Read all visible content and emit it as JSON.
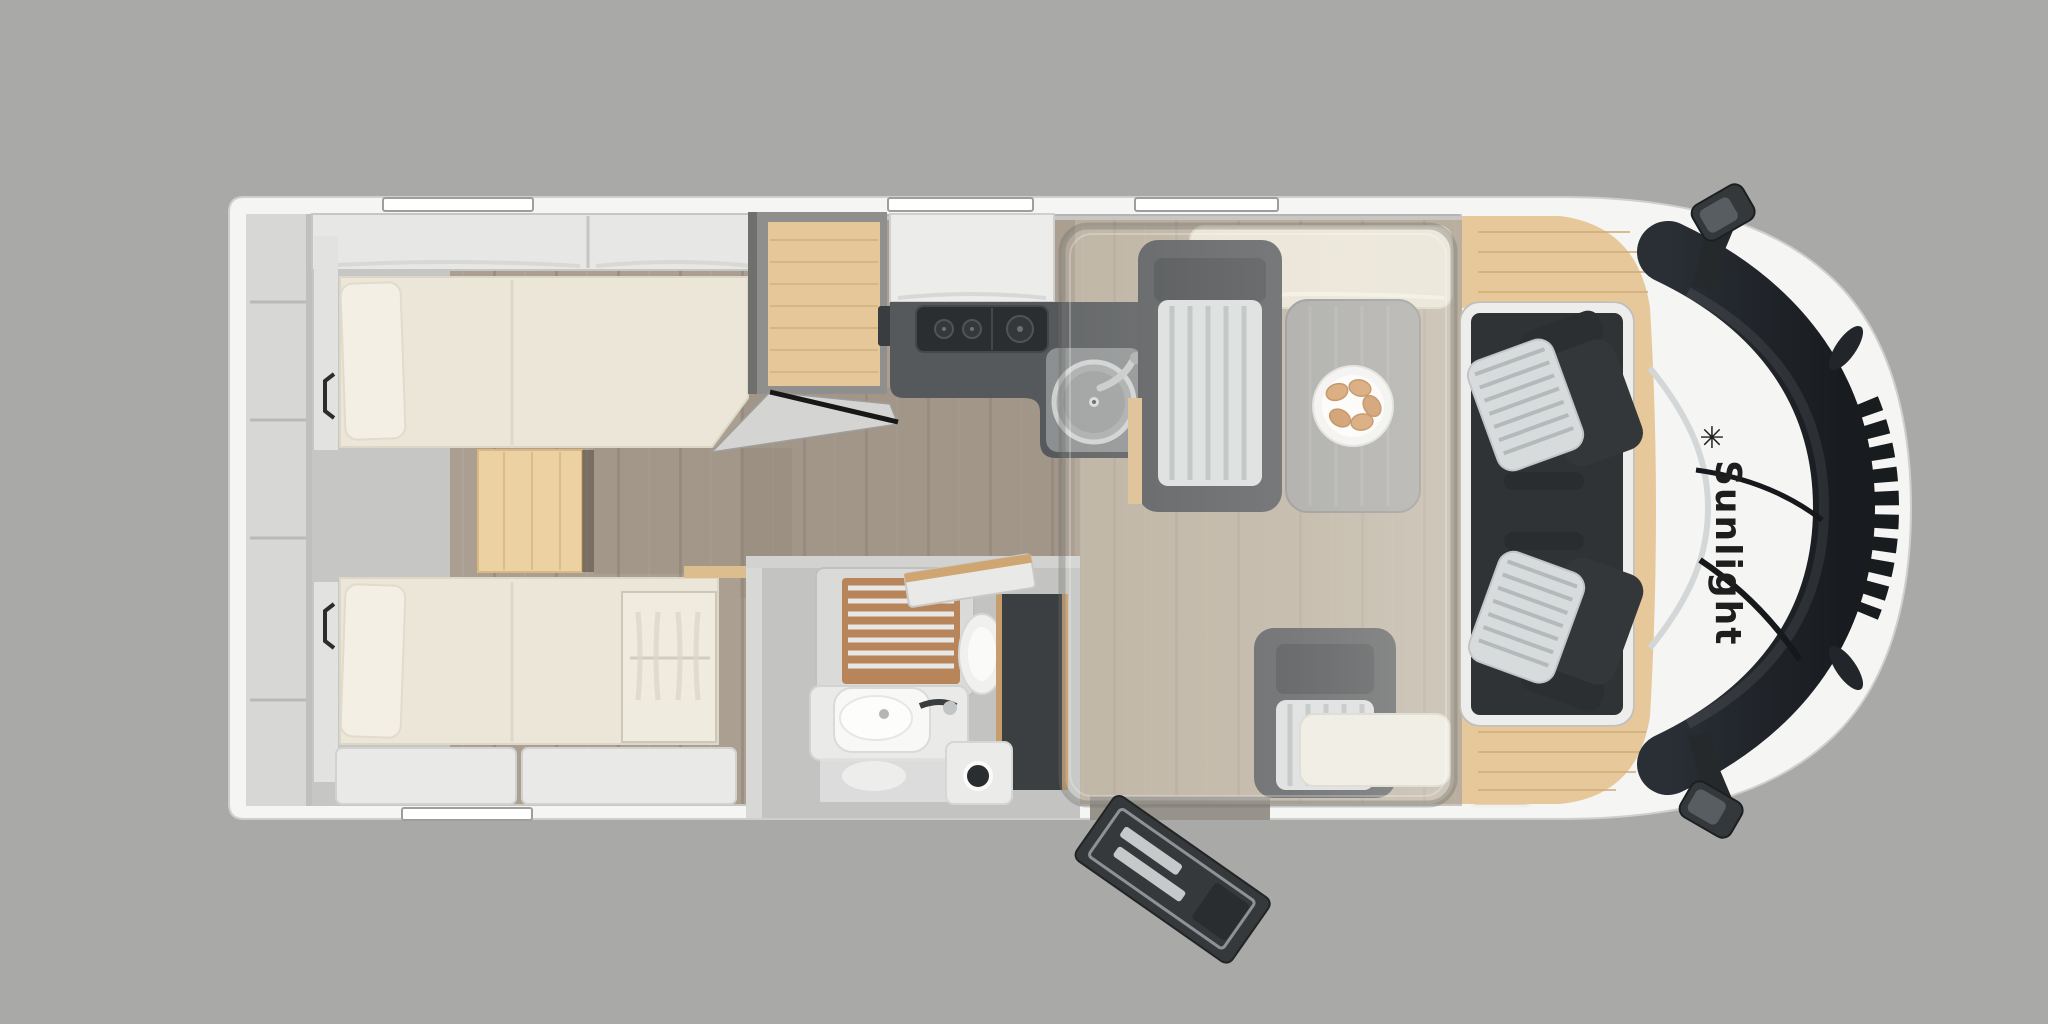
{
  "brand": {
    "name": "Sunlight",
    "logo_glyph": "✳",
    "text_color": "#1e1e1e"
  },
  "palette": {
    "background": "#a9a9a7",
    "body_white": "#f5f5f4",
    "wall_gray": "#c9c9c8",
    "cabinet_white": "#e9e9e8",
    "floor_wood": "#ab9f91",
    "floor_wood_light": "#c7bbaa",
    "accent_wood": "#e5c79a",
    "mattress_cream": "#ece6d8",
    "lounge_cream": "#e9e3d4",
    "counter_dark": "#56595b",
    "stove_black": "#2b2e30",
    "seat_dark": "#36393c",
    "cushion_stripe_light": "#dbdedf",
    "cushion_stripe_line": "#b9bec0",
    "table_gray": "#a2a2a0",
    "shower_teak": "#b8855a",
    "screen_dark": "#3c3f41",
    "windshield_dark": "#22262b",
    "croissant": "#d2975f"
  }
}
